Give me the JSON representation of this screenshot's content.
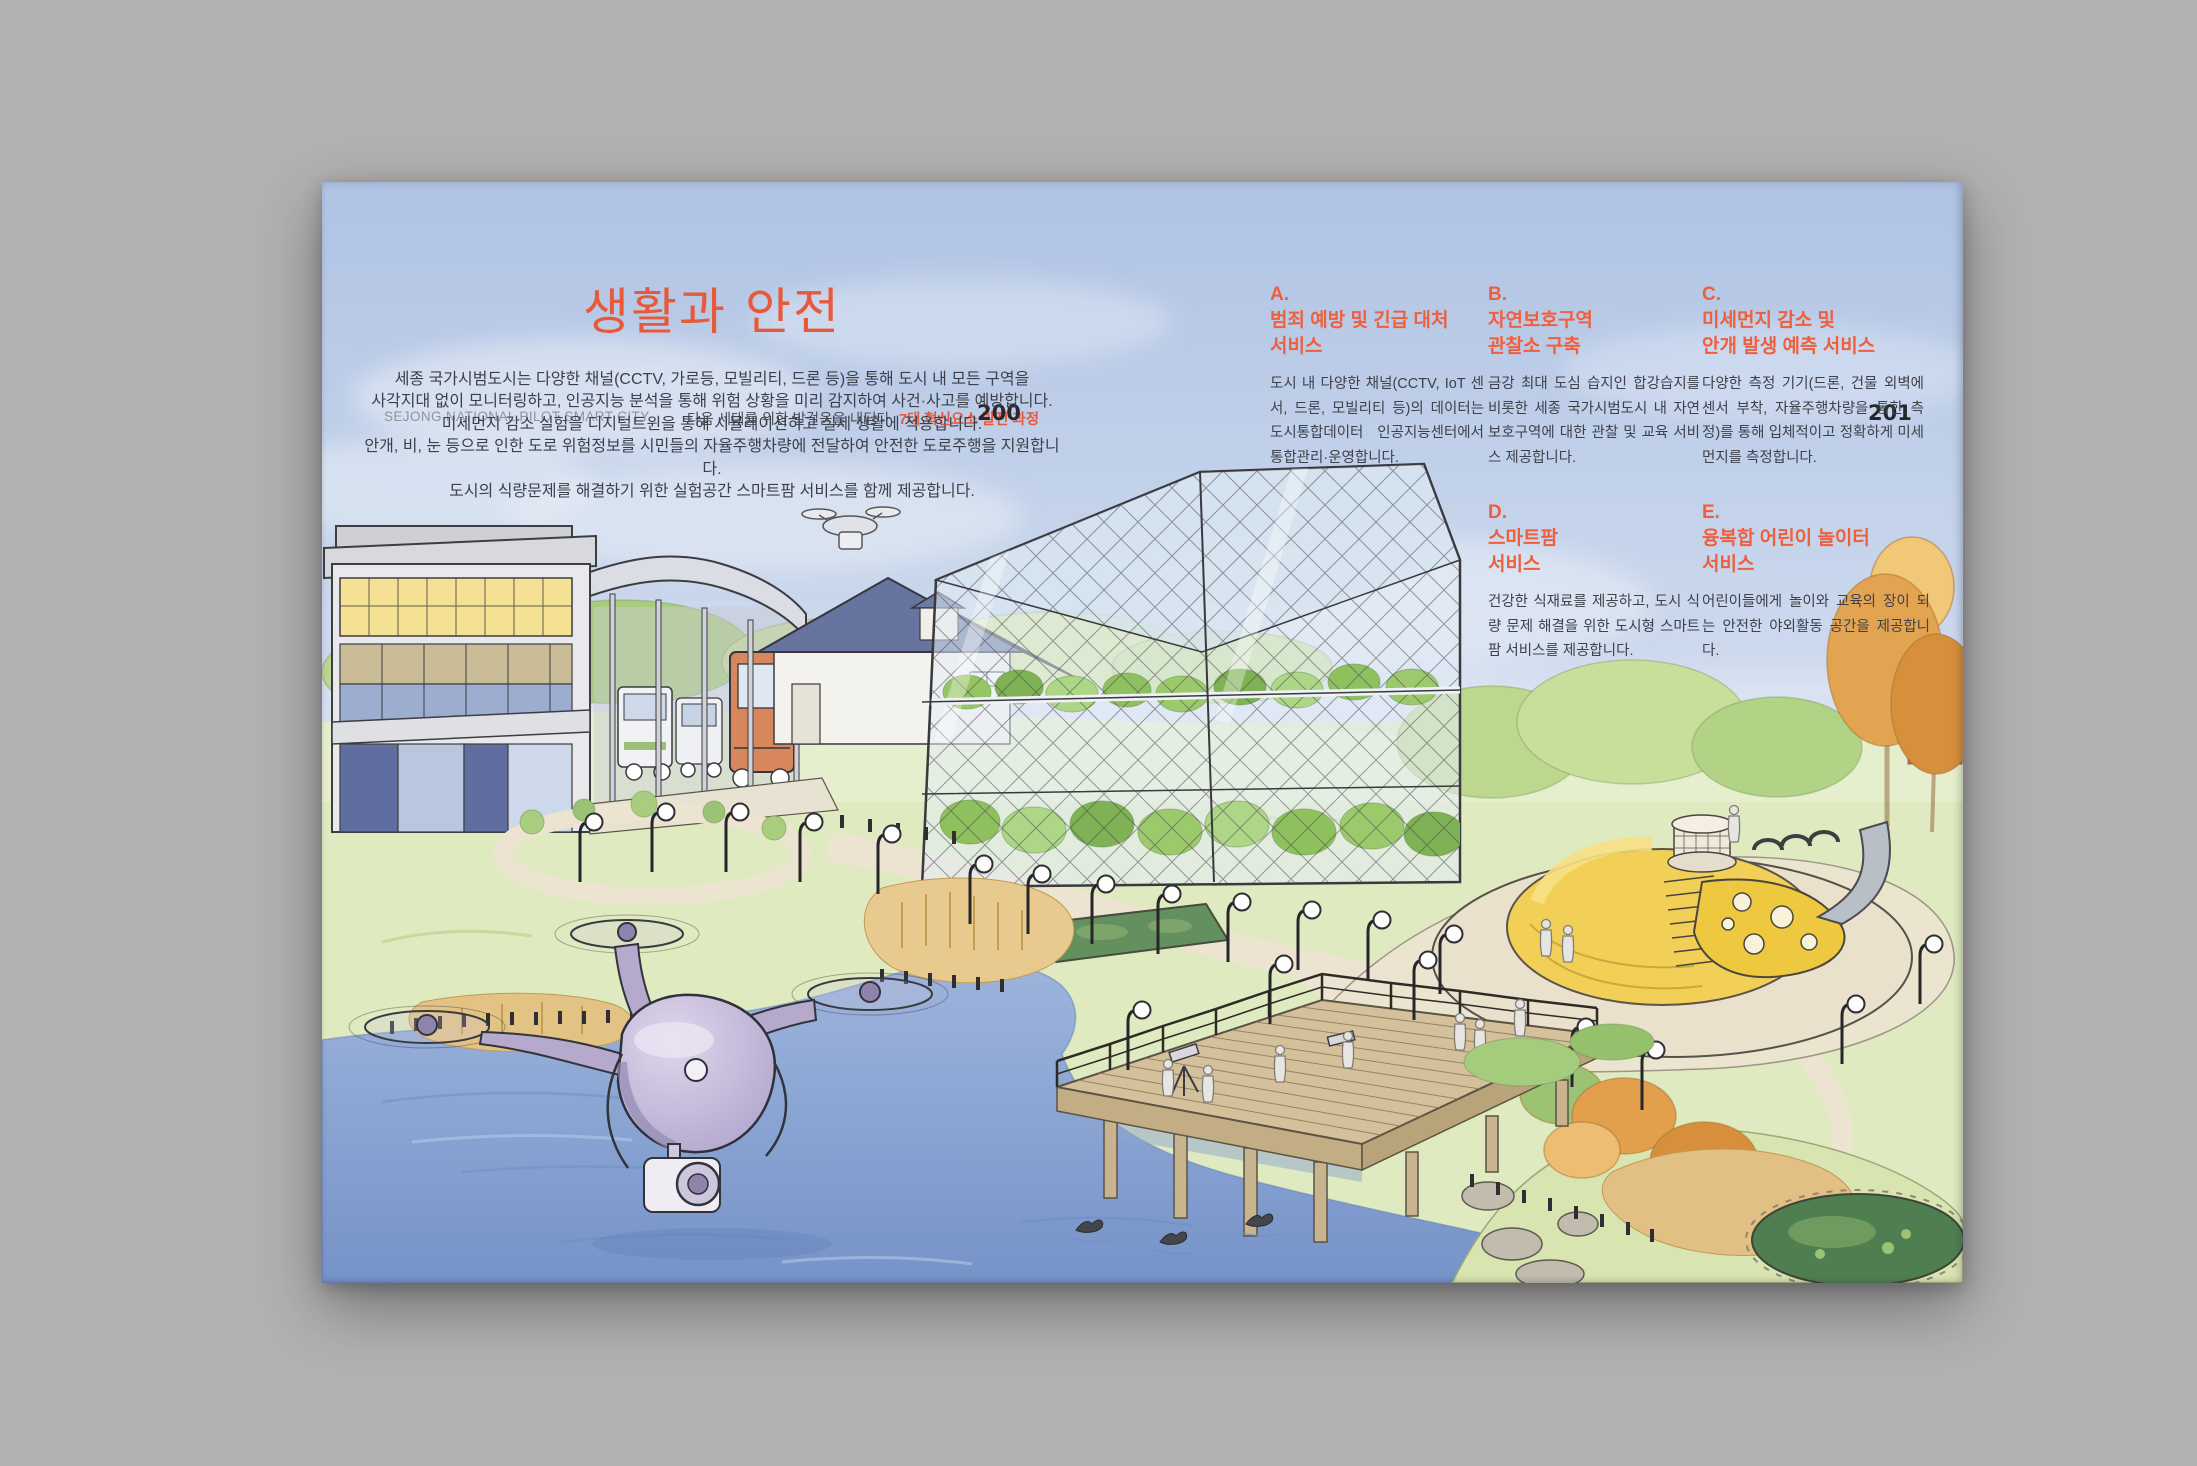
{
  "colors": {
    "accent": "#e8593a",
    "desk_background": "#b4b2b0",
    "sky_top": "#b0c3e4",
    "sky_bottom": "#d8e2f1",
    "lake": "#7e9bce",
    "page_number": "#26272c"
  },
  "spread": {
    "header": {
      "left_label": "SEJONG NATIONAL PILOT SMART CITY",
      "center_label": "다음 세대를 위한 발걸음을 내딛다",
      "center_label_accent": "7대 혁신요소 발전 과정",
      "page_number_left": "200",
      "page_number_right": "201"
    },
    "title": "생활과 안전",
    "intro_lines": [
      "세종 국가시범도시는 다양한 채널(CCTV, 가로등, 모빌리티, 드론 등)을 통해 도시 내 모든 구역을",
      "사각지대 없이 모니터링하고, 인공지능 분석을 통해 위험 상황을 미리 감지하여 사건·사고를 예방합니다.",
      "미세먼지 감소 실험을 디지털트윈을 통해 시뮬레이션하고 실제 생활에 적용합니다.",
      "안개, 비, 눈 등으로 인한 도로 위험정보를 시민들의 자율주행차량에 전달하여 안전한 도로주행을 지원합니다.",
      "도시의 식량문제를 해결하기 위한 실험공간 스마트팜 서비스를 함께 제공합니다."
    ],
    "services": [
      {
        "id": "A.",
        "title1": "범죄 예방 및 긴급 대처",
        "title2": "서비스",
        "body": "도시 내 다양한 채널(CCTV, IoT 센서, 드론, 모빌리티 등)의 데이터는 도시통합데이터 인공지능센터에서 통합관리·운영합니다."
      },
      {
        "id": "B.",
        "title1": "자연보호구역",
        "title2": "관찰소 구축",
        "body": "금강 최대 도심 습지인 합강습지를 비롯한 세종 국가시범도시 내 자연보호구역에 대한 관찰 및 교육 서비스 제공합니다."
      },
      {
        "id": "C.",
        "title1": "미세먼지 감소 및",
        "title2": "안개 발생 예측 서비스",
        "body": "다양한 측정 기기(드론, 건물 외벽에 센서 부착, 자율주행차량을 통한 측정)를 통해 입체적이고 정확하게 미세먼지를 측정합니다."
      },
      {
        "id": "D.",
        "title1": "스마트팜",
        "title2": "서비스",
        "body": "건강한 식재료를 제공하고, 도시 식량 문제 해결을 위한 도시형 스마트팜 서비스를 제공합니다."
      },
      {
        "id": "E.",
        "title1": "융복합 어린이 놀이터",
        "title2": "서비스",
        "body": "어린이들에게 놀이와 교육의 장이 되는 안전한 야외활동 공간을 제공합니다."
      }
    ],
    "illustration": {
      "alt": "Watercolor sketch of the Sejong smart city: surveillance drone over a lake, smart-farm greenhouse, office building with shuttle garage, house, observation deck with telescopes, playground hill with slide, street lamps, autumn trees and ponds",
      "elements": [
        "surveillance-drone",
        "small-drone",
        "smart-farm-greenhouse",
        "office-building",
        "shuttle-garage",
        "blue-roof-house",
        "observation-deck",
        "playground-hill",
        "slide",
        "lake",
        "street-lamps",
        "birds",
        "autumn-trees",
        "pond",
        "reeds"
      ]
    }
  }
}
